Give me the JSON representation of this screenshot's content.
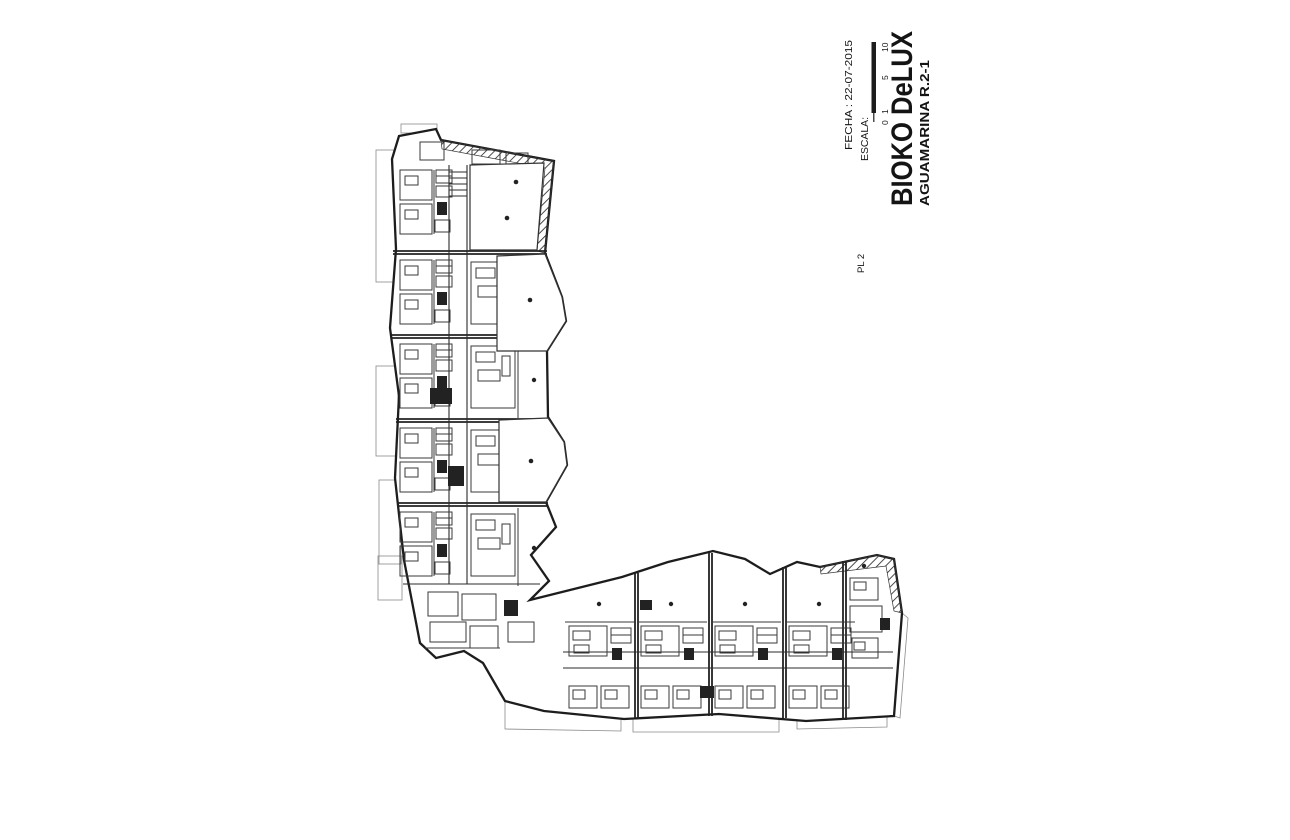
{
  "sheet": {
    "title": "BIOKO DeLUX",
    "subtitle": "AGUAMARINA R.2-1",
    "scale_label": "ESCALA:",
    "scale_ticks": [
      "0",
      "1",
      "5",
      "10"
    ],
    "date": "FECHA : 22-07-2015",
    "plan_label": "PL 2"
  },
  "colors": {
    "ink": "#222222",
    "paper": "#ffffff"
  }
}
